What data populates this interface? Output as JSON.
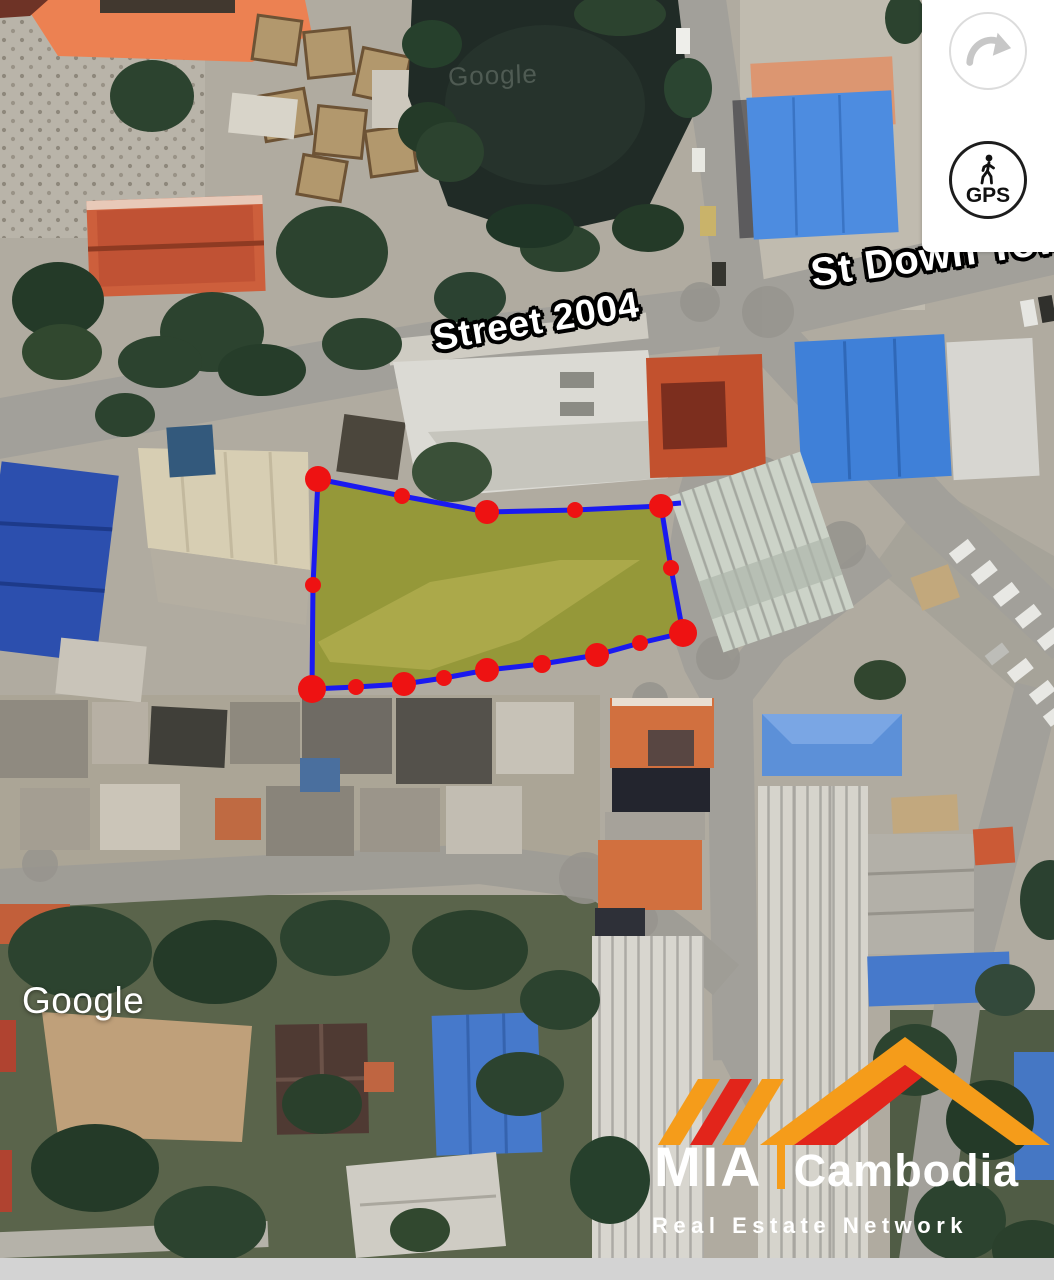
{
  "map": {
    "provider_watermark": "Google",
    "ghost_watermark": "Google",
    "street_labels": [
      {
        "id": "street-2004",
        "text": "Street 2004"
      },
      {
        "id": "st-down-town",
        "text": "St Down Tow"
      }
    ]
  },
  "controls": {
    "panel_bg": "#ffffff",
    "rotate_button": {
      "icon": "curved-arrow-icon"
    },
    "gps_button": {
      "label": "GPS",
      "icon": "walking-person-icon"
    }
  },
  "overlay": {
    "parcel": {
      "fill": "#d8cf2e",
      "fill_opacity": 0.42,
      "stroke": "#1a1af0",
      "stroke_width": 5,
      "dot_color": "#ee1212",
      "outline": [
        [
          318,
          479
        ],
        [
          402,
          496
        ],
        [
          487,
          512
        ],
        [
          575,
          510
        ],
        [
          661,
          506
        ],
        [
          671,
          568
        ],
        [
          683,
          633
        ],
        [
          640,
          643
        ],
        [
          597,
          655
        ],
        [
          542,
          664
        ],
        [
          487,
          670
        ],
        [
          444,
          678
        ],
        [
          404,
          684
        ],
        [
          356,
          687
        ],
        [
          312,
          689
        ],
        [
          313,
          585
        ]
      ],
      "dots": [
        {
          "x": 318,
          "y": 479,
          "r": 13
        },
        {
          "x": 402,
          "y": 496,
          "r": 8
        },
        {
          "x": 487,
          "y": 512,
          "r": 12
        },
        {
          "x": 575,
          "y": 510,
          "r": 8
        },
        {
          "x": 661,
          "y": 506,
          "r": 12
        },
        {
          "x": 671,
          "y": 568,
          "r": 8
        },
        {
          "x": 683,
          "y": 633,
          "r": 14
        },
        {
          "x": 640,
          "y": 643,
          "r": 8
        },
        {
          "x": 597,
          "y": 655,
          "r": 12
        },
        {
          "x": 542,
          "y": 664,
          "r": 9
        },
        {
          "x": 487,
          "y": 670,
          "r": 12
        },
        {
          "x": 444,
          "y": 678,
          "r": 8
        },
        {
          "x": 404,
          "y": 684,
          "r": 12
        },
        {
          "x": 356,
          "y": 687,
          "r": 8
        },
        {
          "x": 312,
          "y": 689,
          "r": 14
        },
        {
          "x": 313,
          "y": 585,
          "r": 8
        }
      ]
    }
  },
  "logo": {
    "brand": "MIA",
    "region": "Cambodia",
    "tagline": "Real Estate Network",
    "colors": {
      "orange": "#F59C1A",
      "red": "#E2251B",
      "text": "#FFFFFF"
    }
  },
  "footer_bar_color": "#d3d3d3"
}
